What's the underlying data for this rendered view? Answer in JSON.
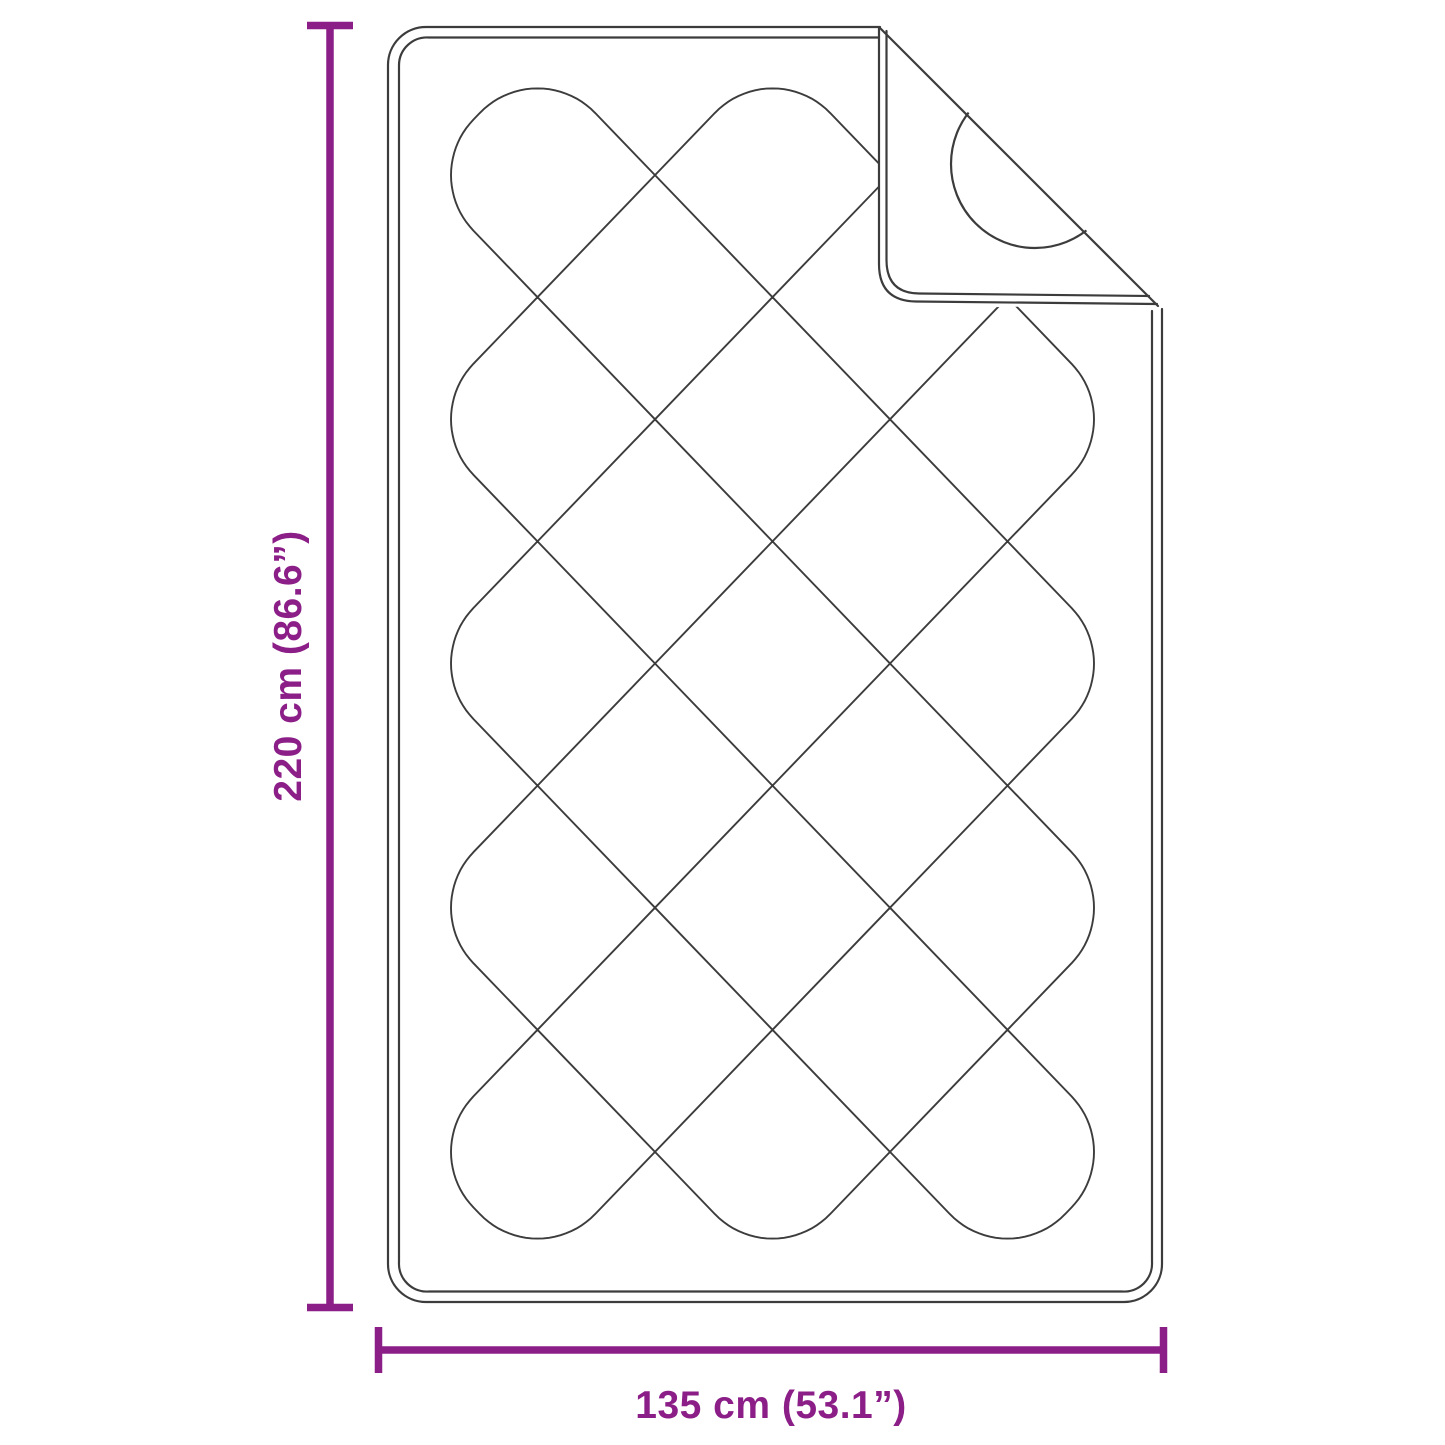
{
  "diagram": {
    "type": "product-dimension-line-drawing",
    "subject": "quilted pad with folded corner"
  },
  "dimensions": {
    "height": {
      "label": "220 cm (86.6”)",
      "value_cm": 220,
      "value_inch": 86.6
    },
    "width": {
      "label": "135 cm (53.1”)",
      "value_cm": 135,
      "value_inch": 53.1
    }
  },
  "colors": {
    "dimension_accent": "#8B1E87",
    "line_art": "#3c3c3c",
    "background": "#ffffff"
  }
}
